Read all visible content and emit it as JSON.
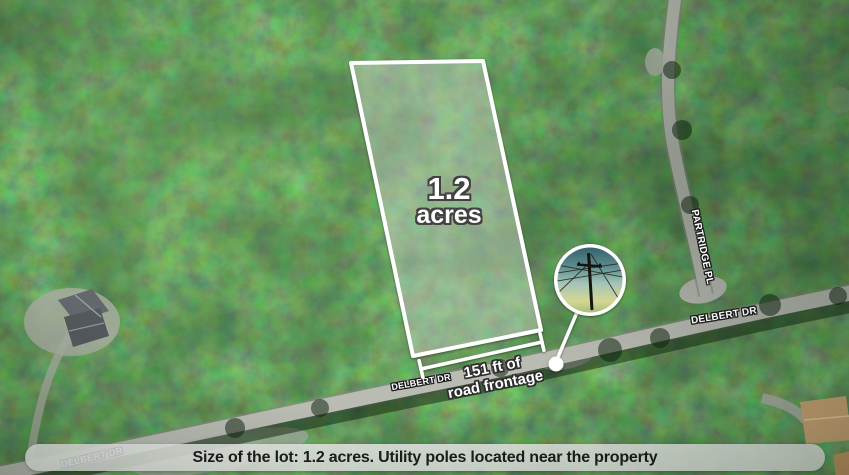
{
  "map": {
    "lot": {
      "size_value": "1.2",
      "size_unit": "acres"
    },
    "frontage": {
      "line1": "151 ft of",
      "line2": "road frontage"
    },
    "road_labels": {
      "delbert_bottom": "DELBERT DR",
      "delbert_mid": "DELBERT DR",
      "delbert_right": "DELBERT DR",
      "partridge": "PARTRIDGE PL"
    },
    "inset": {
      "icon": "utility-pole-icon"
    }
  },
  "caption": {
    "text": "Size of the lot: 1.2 acres. Utility poles located near the property"
  },
  "colors": {
    "parcel_outline": "#ffffff",
    "parcel_fill": "rgba(255,255,255,0.28)",
    "annotation_text": "#ffffff",
    "annotation_outline": "#3a3a3a",
    "road": "#babcb4",
    "caption_bg": "rgba(236,238,234,0.88)",
    "caption_text": "#1c1c1c"
  }
}
